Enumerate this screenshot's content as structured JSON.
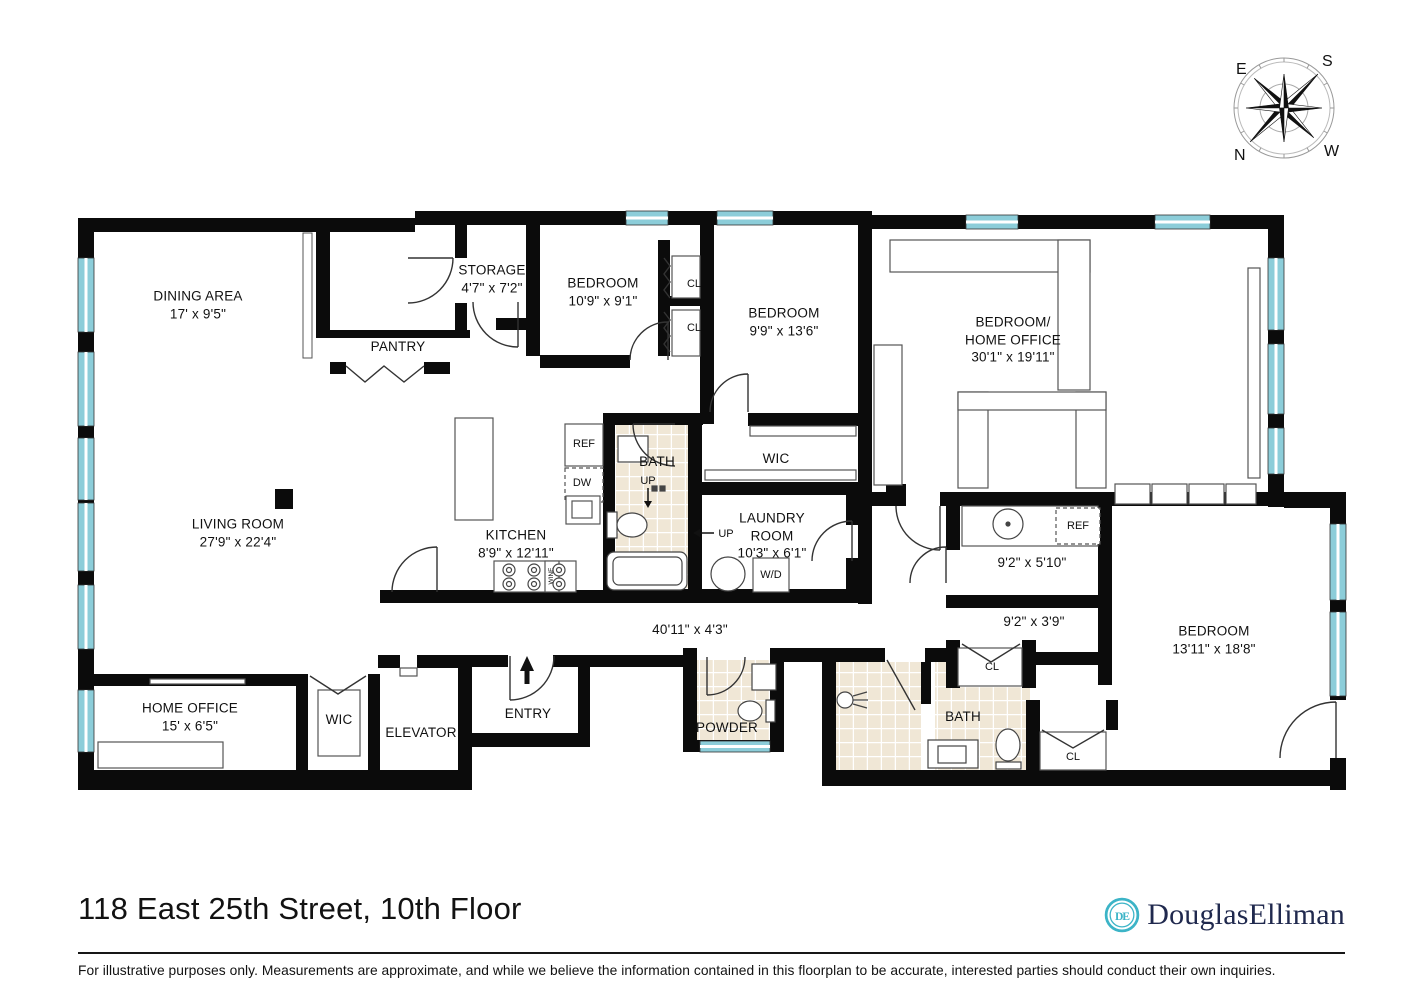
{
  "title": "118 East 25th Street, 10th Floor",
  "disclaimer": "For illustrative purposes only.  Measurements are approximate, and while we believe the information contained in this floorplan to be accurate, interested parties should conduct their own inquiries.",
  "brand": {
    "douglas": "Douglas",
    "elliman": "Elliman",
    "monogram": "DE",
    "accent": "#3cb4c7",
    "navy": "#20294e"
  },
  "compass": {
    "top_left": "E",
    "top_right": "S",
    "bottom_left": "N",
    "bottom_right": "W"
  },
  "colors": {
    "wall": "#0b0b0b",
    "window": "#8ccdd9",
    "tile": "#f0e7d6"
  },
  "labels": {
    "cl": "CL",
    "ref": "REF",
    "dw": "DW",
    "up": "UP",
    "wd": "W/D",
    "wine": "WINE"
  },
  "rooms": {
    "dining": {
      "name": "DINING AREA",
      "dims": "17' x 9'5\""
    },
    "storage": {
      "name": "STORAGE",
      "dims": "4'7\" x 7'2\""
    },
    "pantry": {
      "name": "PANTRY"
    },
    "bedroom1": {
      "name": "BEDROOM",
      "dims": "10'9\" x 9'1\""
    },
    "bedroom2": {
      "name": "BEDROOM",
      "dims": "9'9\" x 13'6\""
    },
    "bedroom_home_office": {
      "line1": "BEDROOM/",
      "line2": "HOME OFFICE",
      "dims": "30'1\" x 19'11\""
    },
    "wic_upper": {
      "name": "WIC"
    },
    "bath_upper": {
      "name": "BATH"
    },
    "kitchen": {
      "name": "KITCHEN",
      "dims": "8'9\" x 12'11\""
    },
    "living": {
      "name": "LIVING ROOM",
      "dims": "27'9\" x 22'4\""
    },
    "laundry": {
      "line1": "LAUNDRY",
      "line2": "ROOM",
      "dims": "10'3\" x 6'1\""
    },
    "wet_bar": {
      "dims": "9'2\" x 5'10\""
    },
    "hallway": {
      "dims": "40'11\" x 4'3\""
    },
    "closet_passage": {
      "dims": "9'2\" x 3'9\""
    },
    "bedroom3": {
      "name": "BEDROOM",
      "dims": "13'11\" x 18'8\""
    },
    "home_office": {
      "name": "HOME OFFICE",
      "dims": "15' x 6'5\""
    },
    "wic_lower": {
      "name": "WIC"
    },
    "elevator": {
      "name": "ELEVATOR"
    },
    "entry": {
      "name": "ENTRY"
    },
    "powder": {
      "name": "POWDER"
    },
    "bath_lower": {
      "name": "BATH"
    }
  }
}
